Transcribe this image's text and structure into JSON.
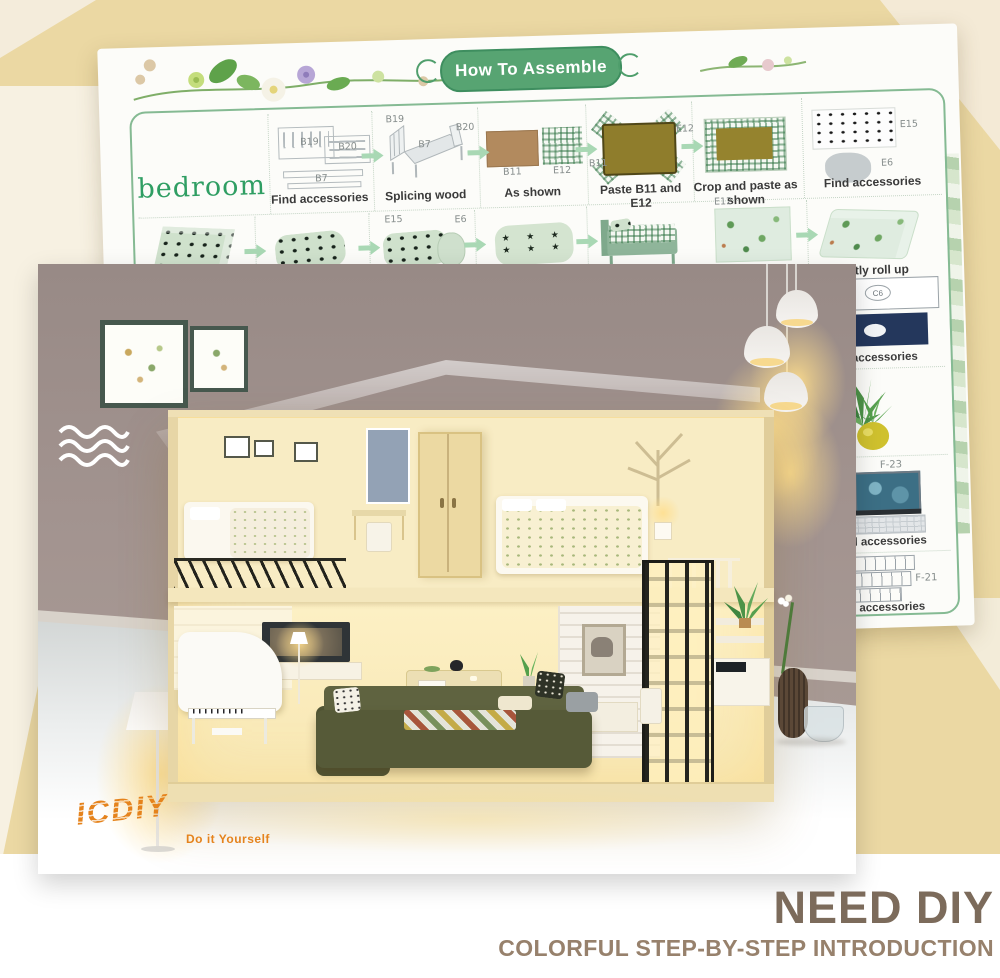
{
  "colors": {
    "accent_green": "#57a472",
    "sheet_border_green": "#85ba93",
    "bedroom_green": "#2f9e63",
    "arrow_green": "#a9d8b4",
    "logo_orange": "#e5831c",
    "footer_title_brown": "#7c6b5b",
    "footer_subtitle_taupe": "#97816c",
    "envelope_tan": "#ebd8a3",
    "envelope_cream": "#f7f1e2"
  },
  "sheet": {
    "title": "How To Assemble",
    "section_label": "bedroom",
    "row1": [
      {
        "caption": "Find accessories",
        "parts": [
          "B19",
          "B20",
          "B7"
        ]
      },
      {
        "caption": "Splicing wood",
        "parts": [
          "B19",
          "B7",
          "B20"
        ]
      },
      {
        "caption": "As shown",
        "parts": [
          "B11",
          "E12"
        ]
      },
      {
        "caption": "Paste B11 and E12",
        "parts": [
          "B11",
          "E12"
        ]
      },
      {
        "caption": "Crop and paste as shown"
      },
      {
        "caption": "Find accessories",
        "parts": [
          "E15",
          "E6"
        ]
      }
    ],
    "row2": [
      {},
      {},
      {
        "parts": [
          "E15",
          "E6"
        ]
      },
      {},
      {},
      {
        "caption": "Cut out a slice of",
        "parts": [
          "E12"
        ]
      },
      {
        "caption": "Gently roll up"
      }
    ],
    "right_column": [
      {
        "caption": "d accessories",
        "parts": [
          "C6"
        ]
      },
      {},
      {
        "caption": "nd accessories",
        "parts": [
          "F-23"
        ]
      },
      {
        "caption": "d accessories",
        "parts": [
          "F-21"
        ]
      }
    ]
  },
  "photo": {
    "logo_text": "ICDIY",
    "logo_tagline": "Do it Yourself"
  },
  "footer": {
    "title": "NEED DIY",
    "subtitle": "COLORFUL STEP-BY-STEP INTRODUCTION"
  }
}
